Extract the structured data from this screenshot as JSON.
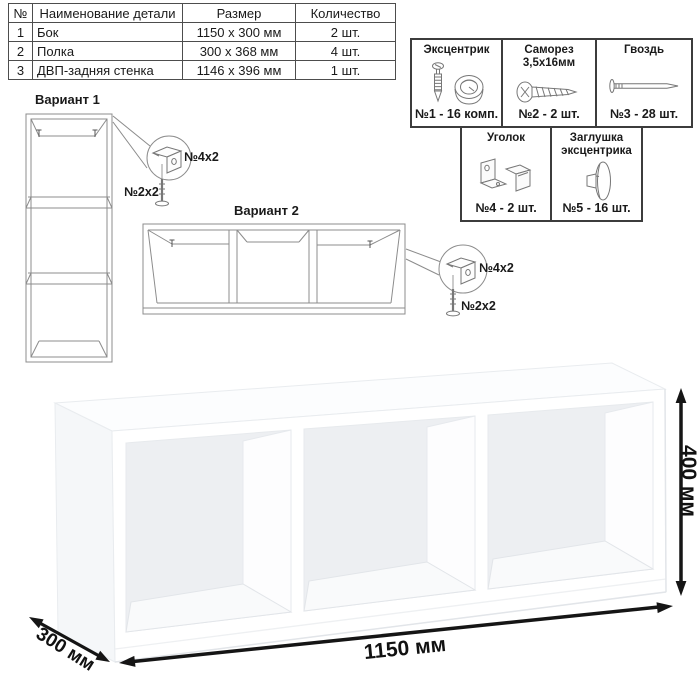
{
  "parts_table": {
    "headers": {
      "num": "№",
      "name": "Наименование детали",
      "size": "Размер",
      "qty": "Количество"
    },
    "rows": [
      {
        "num": "1",
        "name": "Бок",
        "size": "1150 x 300 мм",
        "qty": "2 шт."
      },
      {
        "num": "2",
        "name": "Полка",
        "size": "300 x 368 мм",
        "qty": "4 шт."
      },
      {
        "num": "3",
        "name": "ДВП-задняя стенка",
        "size": "1146 x 396 мм",
        "qty": "1 шт."
      }
    ]
  },
  "hardware": {
    "items": [
      {
        "title": "Эксцентрик",
        "title2": "",
        "label": "№1 - 16 комп.",
        "icon": "eccentric-cam-icon"
      },
      {
        "title": "Саморез",
        "title2": "3,5х16мм",
        "label": "№2 - 2 шт.",
        "icon": "screw-icon"
      },
      {
        "title": "Гвоздь",
        "title2": "",
        "label": "№3 - 28 шт.",
        "icon": "nail-icon"
      },
      {
        "title": "Уголок",
        "title2": "",
        "label": "№4 - 2 шт.",
        "icon": "corner-bracket-icon"
      },
      {
        "title": "Заглушка",
        "title2": "эксцентрика",
        "label": "№5 - 16 шт.",
        "icon": "cam-cap-icon"
      }
    ]
  },
  "variant1": {
    "title": "Вариант 1",
    "bracket_label": "№4х2",
    "screw_label": "№2х2"
  },
  "variant2": {
    "title": "Вариант 2",
    "bracket_label": "№4х2",
    "screw_label": "№2х2"
  },
  "dimensions": {
    "width": "1150 мм",
    "height": "400 мм",
    "depth": "300 мм"
  },
  "colors": {
    "table_border": "#4d4d4d",
    "box_border": "#3c3c3c",
    "line_drawing": "#8c8c8c",
    "dimension": "#111111",
    "shelf_back_panel": "#edeff2"
  }
}
